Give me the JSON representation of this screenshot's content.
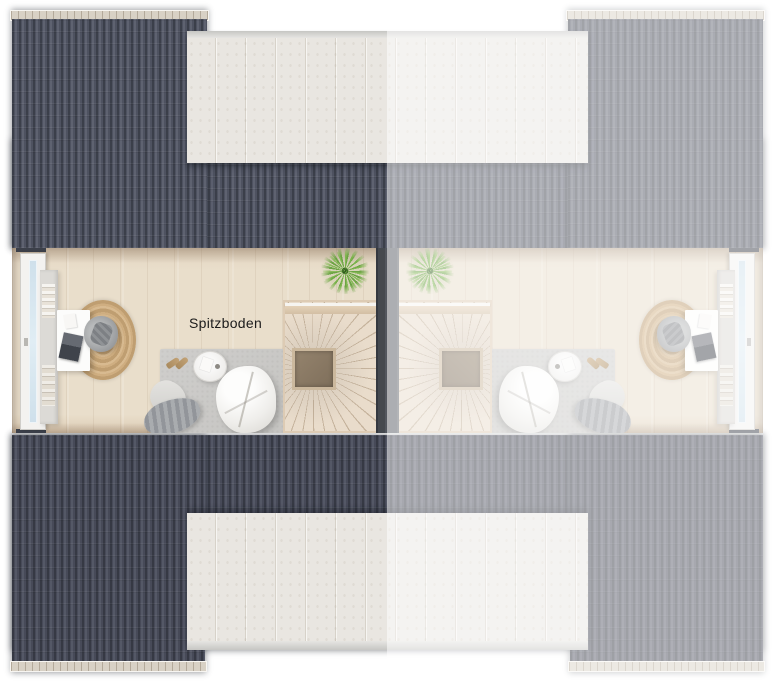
{
  "plan": {
    "room_label": "Spitzboden",
    "units": {
      "left": {
        "name": "left-unit",
        "state": "active",
        "label": "Spitzboden"
      },
      "right": {
        "name": "right-unit",
        "state": "faded-mirrored"
      }
    },
    "colors": {
      "roof_dark_a": "#3b3f4a",
      "roof_dark_b": "#4e5260",
      "roof_dark_c": "#6d7180",
      "ridge_cap": "#d8d1c5",
      "dormer_panel": "#e9e6e1",
      "dormer_seam": "#d7d2c9",
      "floor_light": "#e9decb",
      "party_wall": "#45494f",
      "stair_wood": "#e9dccb",
      "stair_void": "#7f6f5b",
      "rug_gray": "#c5c4c1",
      "rug_jute": "#bf9e71",
      "plant_green": "#6aa43c",
      "background": "#ffffff",
      "fade_overlay": "rgba(255,255,255,0.52)"
    }
  }
}
